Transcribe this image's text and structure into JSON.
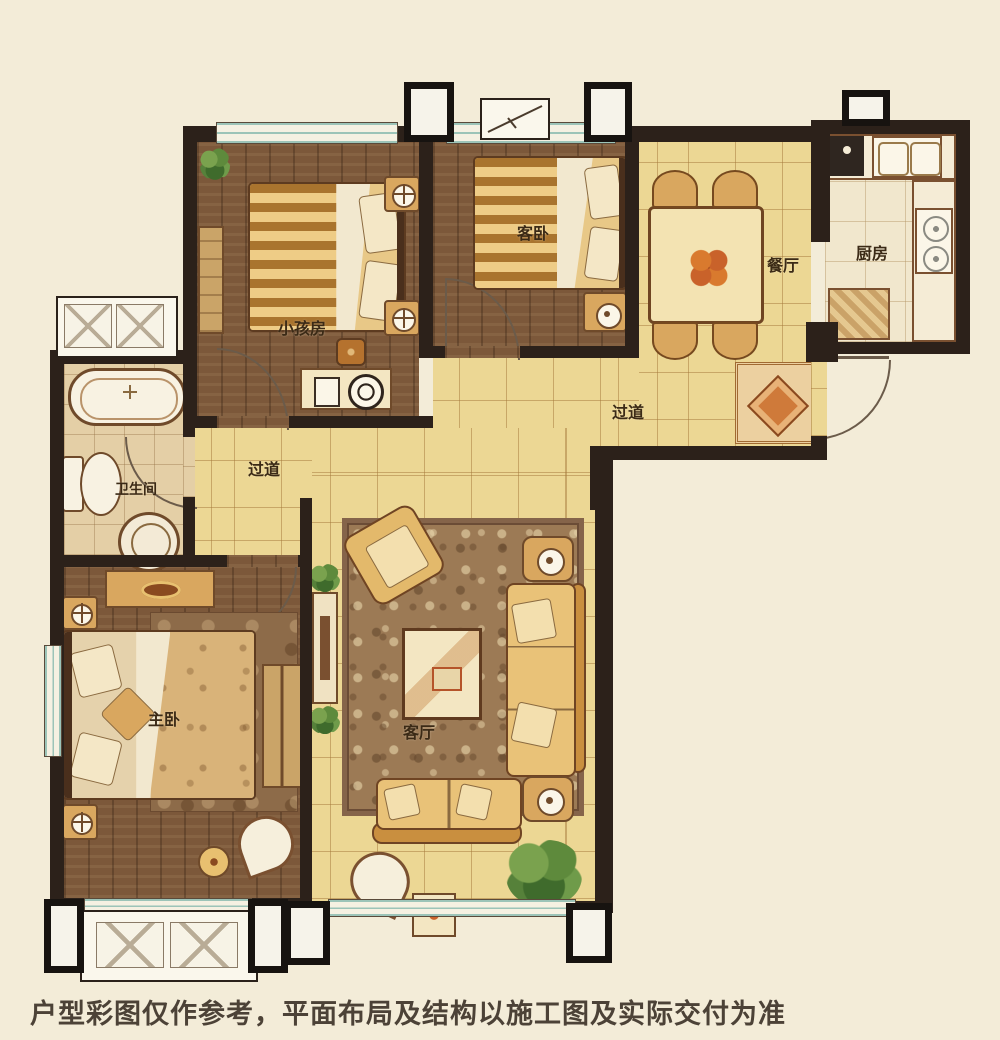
{
  "plan": {
    "title": "residential-floor-plan",
    "disclaimer": "户型彩图仅作参考，平面布局及结构以施工图及实际交付为准",
    "rooms": {
      "children_room": {
        "label": "小孩房"
      },
      "guest_bedroom": {
        "label": "客卧"
      },
      "dining_room": {
        "label": "餐厅"
      },
      "kitchen": {
        "label": "厨房"
      },
      "corridor_top": {
        "label": "过道"
      },
      "corridor_left": {
        "label": "过道"
      },
      "bathroom": {
        "label": "卫生间"
      },
      "master_bedroom": {
        "label": "主卧"
      },
      "living_room": {
        "label": "客厅"
      }
    },
    "colors": {
      "background": "#f3ecd8",
      "wall": "#2c211a",
      "wood_floor": "#7c583a",
      "tile_floor": "#ecd794",
      "window_glass": "#9cc4b8",
      "label_text": "#3b2a16"
    }
  }
}
